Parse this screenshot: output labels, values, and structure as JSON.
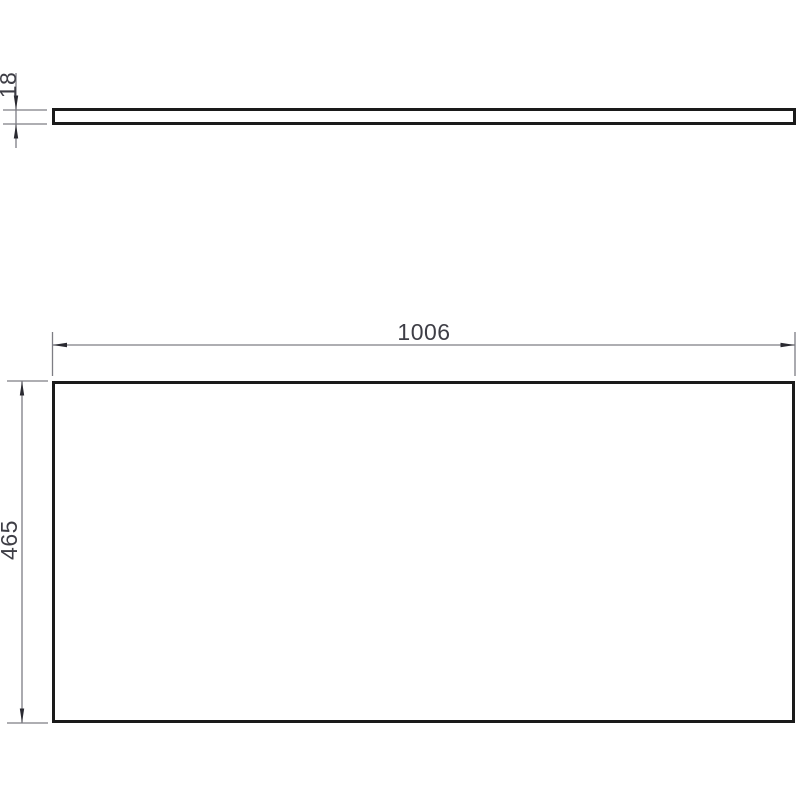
{
  "drawing": {
    "kind": "technical-drawing",
    "subject": "rectangular panel",
    "views": {
      "side": {
        "name": "side profile view",
        "thickness": {
          "label": "18"
        }
      },
      "front": {
        "name": "front view",
        "width": {
          "label": "1006"
        },
        "height": {
          "label": "465"
        }
      }
    },
    "colors": {
      "background": "#ffffff",
      "outline": "#1a1a1a",
      "dimension_line": "#7d7d84",
      "arrowhead": "#2a2a31",
      "text": "#3e3e46"
    }
  }
}
